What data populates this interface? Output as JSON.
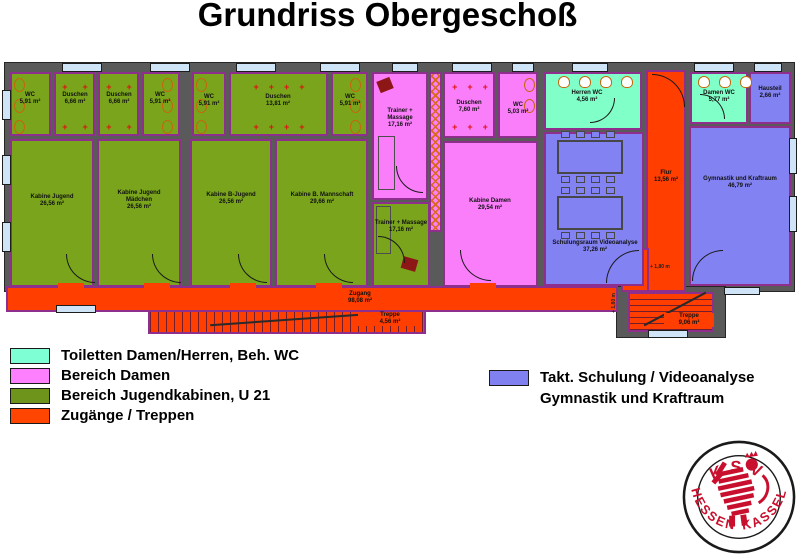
{
  "title": "Grundriss Obergeschoß",
  "colors": {
    "toilets": "#7fffd4",
    "bereich_damen": "#ff80ff",
    "jugendkabinen": "#6f941b",
    "zugaenge": "#ff4500",
    "schulung_gymnastik": "#8080f0",
    "wall": "#5a5a5a",
    "room_outline": "#8e2f8e"
  },
  "rooms": {
    "wc1": {
      "name": "WC",
      "area": "5,91 m²"
    },
    "d1": {
      "name": "Duschen",
      "area": "6,66 m²"
    },
    "d2": {
      "name": "Duschen",
      "area": "6,66 m²"
    },
    "wc2": {
      "name": "WC",
      "area": "5,91 m²"
    },
    "wc3": {
      "name": "WC",
      "area": "5,91 m²"
    },
    "d3": {
      "name": "Duschen",
      "area": "13,81 m²"
    },
    "wc4": {
      "name": "WC",
      "area": "5,91 m²"
    },
    "k1": {
      "name": "Kabine Jugend",
      "area": "26,56 m²"
    },
    "k2": {
      "name": "Kabine Jugend Mädchen",
      "area": "26,56 m²"
    },
    "k3": {
      "name": "Kabine B-Jugend",
      "area": "26,56 m²"
    },
    "k4": {
      "name": "Kabine B. Mannschaft",
      "area": "29,66 m²"
    },
    "trainer1": {
      "name": "Trainer + Massage",
      "area": "17,16 m²"
    },
    "duschen_d": {
      "name": "Duschen",
      "area": "7,60 m²"
    },
    "wc_d": {
      "name": "WC",
      "area": "5,03 m²"
    },
    "kabine_d": {
      "name": "Kabine Damen",
      "area": "29,54 m²"
    },
    "trainer2": {
      "name": "Trainer + Massage",
      "area": "17,16 m²"
    },
    "herren_wc": {
      "name": "Herren WC",
      "area": "4,56 m²"
    },
    "damen_wc": {
      "name": "Damen WC",
      "area": "5,77 m²"
    },
    "hausteil": {
      "name": "Hausteil",
      "area": "2,66 m²"
    },
    "flur": {
      "name": "Flur",
      "area": "13,56 m²"
    },
    "schulung": {
      "name": "Schulungsraum Videoanalyse",
      "area": "37,26 m²"
    },
    "gym": {
      "name": "Gymnastik und Kraftraum",
      "area": "46,79 m²"
    },
    "zugang": {
      "name": "Zugang",
      "area": "98,08 m²"
    },
    "treppe_l": {
      "name": "Treppe",
      "area": "4,56 m²"
    },
    "treppe_r": {
      "name": "Treppe",
      "area": "9,06 m²"
    }
  },
  "annotations": {
    "level1": "+ 1,80 m",
    "level2": "+ 1,80 m"
  },
  "symbols": {
    "cross2": "+      +\n\n+      +",
    "cross3": "+    +    +\n\n+    +    +",
    "cross4": "+    +    +    +\n\n+    +    +    +"
  },
  "legend_left": {
    "items": [
      {
        "label": "Toiletten Damen/Herren, Beh. WC",
        "color": "#7fffd4"
      },
      {
        "label": "Bereich Damen",
        "color": "#ff80ff"
      },
      {
        "label": "Bereich Jugendkabinen, U 21",
        "color": "#6f941b"
      },
      {
        "label": "Zugänge / Treppen",
        "color": "#ff4500"
      }
    ]
  },
  "legend_right": {
    "color": "#8080f0",
    "line1": "Takt. Schulung / Videoanalyse",
    "line2": "Gymnastik und Kraftraum"
  },
  "logo": {
    "top": "KSV",
    "bottom_left": "HESSEN",
    "bottom_right": "KASSEL"
  }
}
